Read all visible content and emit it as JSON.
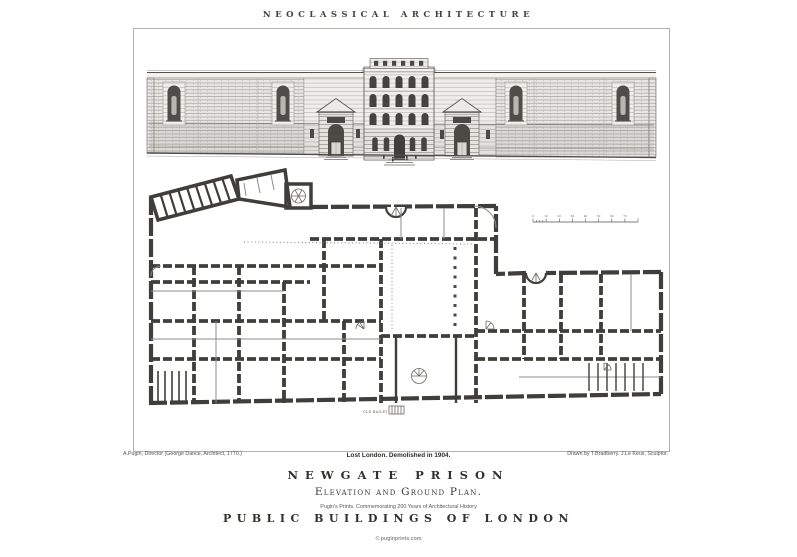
{
  "header": {
    "title": "NEOCLASSICAL ARCHITECTURE"
  },
  "plate": {
    "caption_left": "A.Pugin, Director (George Dance, Architect, 1770.)",
    "caption_right": "Drawn by T.Bradberry. J.Le Keux, Sculptor.",
    "subtitle": "Lost London. Demolished in 1904.",
    "title": "NEWGATE PRISON",
    "drawing_title": "Elevation and Ground Plan.",
    "series_note": "Pugin's Prints. Commemorating 200 Years of Architectural History",
    "series_title": "PUBLIC BUILDINGS OF LONDON"
  },
  "drawing": {
    "street_label": "OLD BAILEY",
    "scale_bar_tick_labels": [
      "0",
      "10",
      "20",
      "30",
      "40",
      "50",
      "60",
      "70"
    ]
  },
  "footer": {
    "watermark": "© puginprints.com"
  },
  "colors": {
    "ink": "#403e3a",
    "paper": "#ffffff",
    "frame_line": "#b3b1ad"
  }
}
